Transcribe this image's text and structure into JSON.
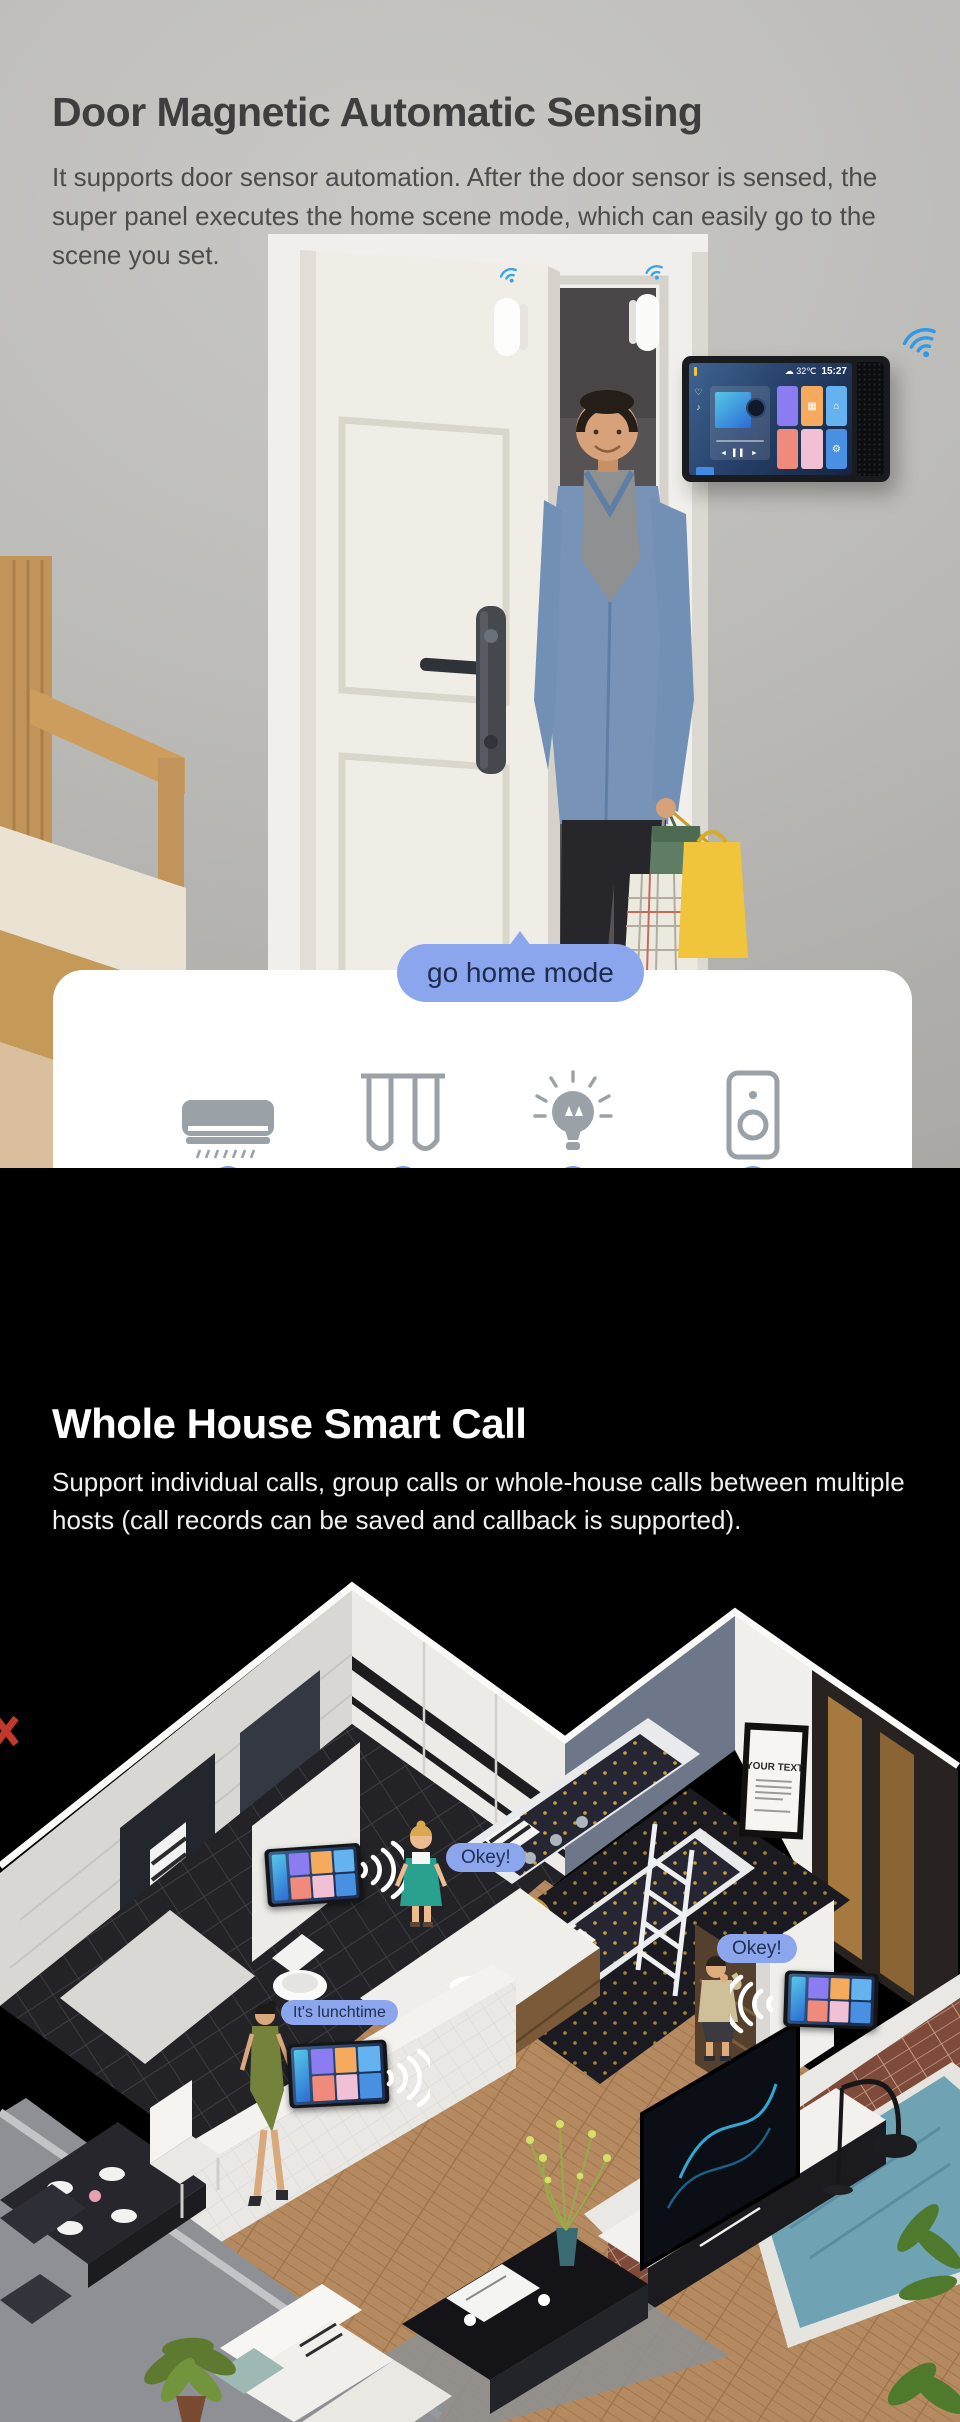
{
  "door_section": {
    "title": "Door Magnetic Automatic Sensing",
    "description": "It supports door sensor automation. After the door sensor is sensed, the super panel executes the home scene mode, which can easily go to the scene you set.",
    "bubble_label": "go home mode",
    "steps": [
      {
        "icon": "air-conditioner-icon",
        "label": "Turn on the A/C"
      },
      {
        "icon": "curtains-icon",
        "label": "open curtains"
      },
      {
        "icon": "light-bulb-icon",
        "label": "Turn on the living room lights"
      },
      {
        "icon": "speaker-icon",
        "label": "turn on music"
      }
    ]
  },
  "wall_panel": {
    "temperature": "32℃",
    "time": "15:27"
  },
  "call_section": {
    "title": "Whole House Smart Call",
    "description": "Support individual calls, group calls or whole-house calls between multiple hosts (call records can be saved and callback is supported).",
    "speech_bubbles": [
      {
        "text": "Okey!"
      },
      {
        "text": "Okey!"
      },
      {
        "text": "It's lunchtime"
      }
    ],
    "poster_title": "YOUR TEXT"
  },
  "colors": {
    "bubble_blue": "#8ca6ee",
    "bubble_text": "#1d2b4e",
    "timeline_dot": "#7b9cf0",
    "wifi_blue": "#2f9be8",
    "icon_gray": "#9aa2a8",
    "section_door_bg": "#bcbbb8",
    "section_call_bg": "#000000"
  }
}
